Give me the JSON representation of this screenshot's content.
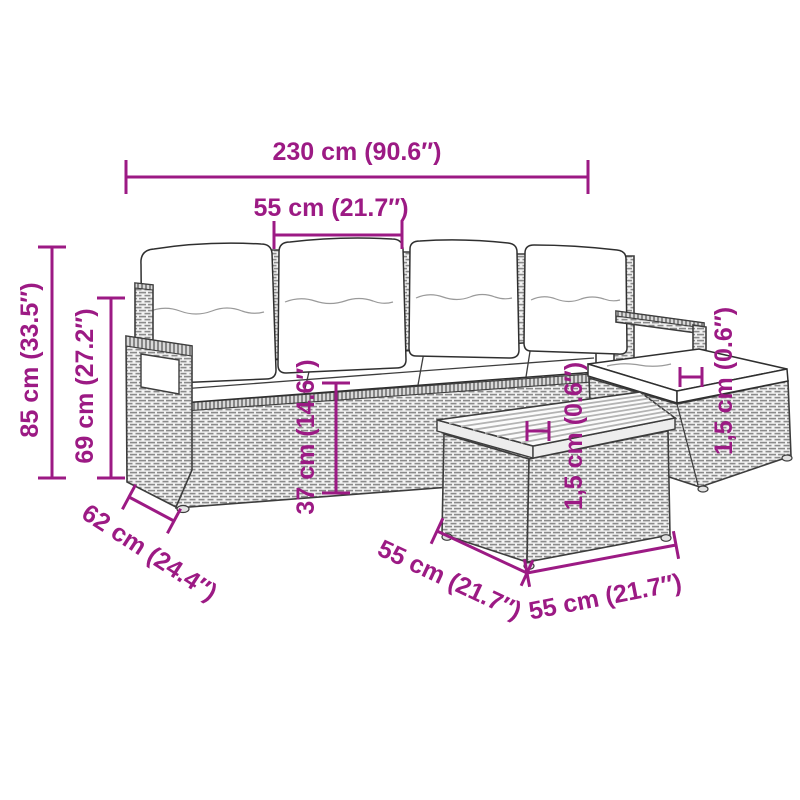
{
  "diagram": {
    "labels": {
      "overall_width": "230 cm (90.6″)",
      "seat_width": "55 cm (21.7″)",
      "overall_height": "85 cm (33.5″)",
      "armrest_height": "69 cm (27.2″)",
      "seat_height": "37 cm (14.6″)",
      "seat_depth": "62 cm (24.4″)",
      "table_depth": "55 cm (21.7″)",
      "table_width": "55 cm (21.7″)",
      "table_top_thickness": "1,5 cm (0.6″)",
      "ottoman_cushion_thickness": "1,5 cm (0.6″)"
    },
    "colors": {
      "dimension_accent": "#9C1A84",
      "line_art": "#3D3D3D",
      "wicker_stroke": "#8A8A8A",
      "cushion_fill": "#FFFFFF"
    }
  }
}
